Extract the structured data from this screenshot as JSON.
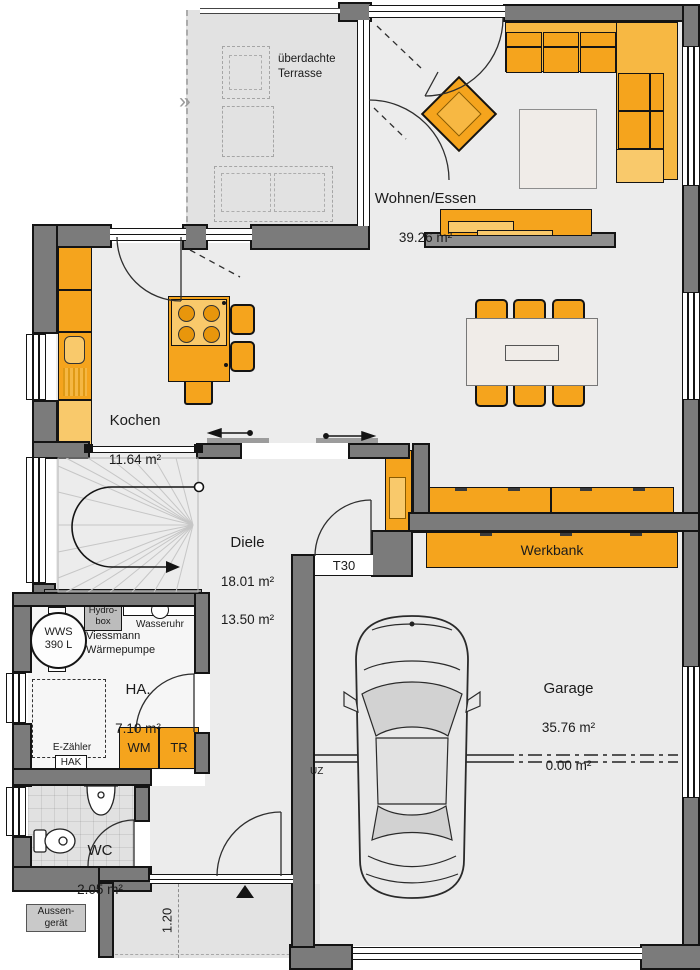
{
  "colors": {
    "wall": "#7b7b7b",
    "outline": "#141414",
    "floor": "#ececec",
    "terrace_floor": "#e2e2e2",
    "furniture_orange": "#F5A41D",
    "furniture_orange_light": "#F9C96B",
    "rug_beige": "#F0ECE8"
  },
  "rooms": {
    "terrace": {
      "label": "überdachte\nTerrasse"
    },
    "living": {
      "name": "Wohnen/Essen",
      "area": "39.26 m²"
    },
    "kitchen": {
      "name": "Kochen",
      "area": "11.64 m²"
    },
    "hall": {
      "name": "Diele",
      "area_1": "18.01 m²",
      "area_2": "13.50 m²"
    },
    "utility": {
      "name": "HA.",
      "area": "7.10 m²"
    },
    "wc": {
      "name": "WC",
      "area": "2.05 m²"
    },
    "garage": {
      "name": "Garage",
      "area_1": "35.76 m²",
      "area_2": "0.00 m²"
    }
  },
  "fixtures": {
    "workbench": "Werkbank",
    "fire_door": "T30",
    "beam": "UZ",
    "outdoor_unit": "Aussen-\ngerät",
    "entry_width": "1.20",
    "hydrobox": "Hydro-\nbox",
    "water_meter": "Wasseruhr",
    "heat_pump": "Viessmann\nWärmepumpe",
    "water_tank": "WWS\n390 L",
    "electric_meter": "E-Zähler",
    "house_connection": "HAK",
    "washer": "WM",
    "dryer": "TR"
  }
}
